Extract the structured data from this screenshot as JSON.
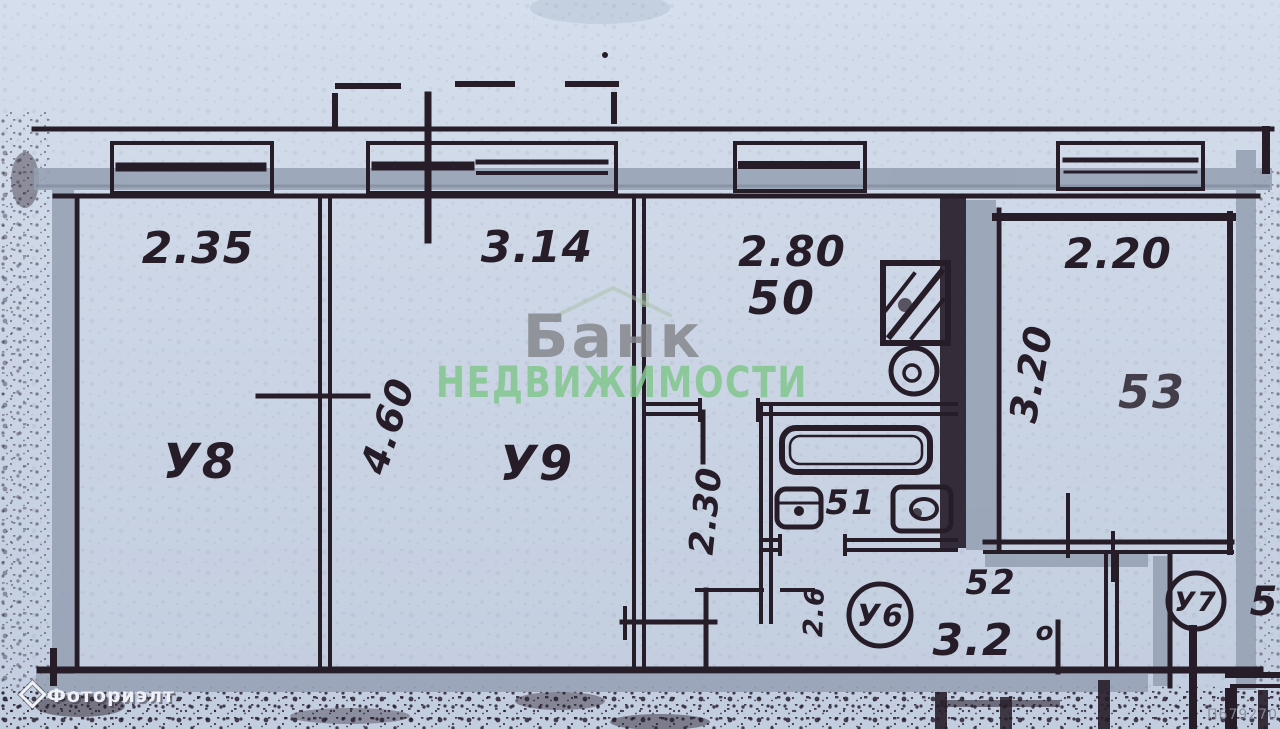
{
  "watermarks": {
    "brand_line1": "Банк",
    "brand_line2": "НЕДВИЖИМОСТИ",
    "agency": "Фоториэлт",
    "ref_code": "П679270"
  },
  "floorplan": {
    "labels": {
      "room_u8": "У8",
      "room_u9": "У9",
      "unit_u6": "У6",
      "unit_u7": "У7",
      "kitchen_no": "50",
      "bath_no": "51",
      "hall_no": "52",
      "room53_no": "53",
      "neighbor_partial": "5"
    },
    "dimensions": {
      "u8_width": "2.35",
      "u9_width": "3.14",
      "u9_depth": "4.60",
      "kitchen_width": "2.80",
      "room53_width": "2.20",
      "room53_depth": "3.20",
      "corridor_depth": "2.30",
      "hall_width": "3.2",
      "hall_width_suffix": "о",
      "hall_side": "2.6"
    }
  },
  "colors": {
    "paper": "#cdd7e6",
    "ink": "#271d29",
    "wall_gray": "#96a1b4",
    "brand_gray": "#85858a",
    "brand_green": "#83c78f"
  }
}
